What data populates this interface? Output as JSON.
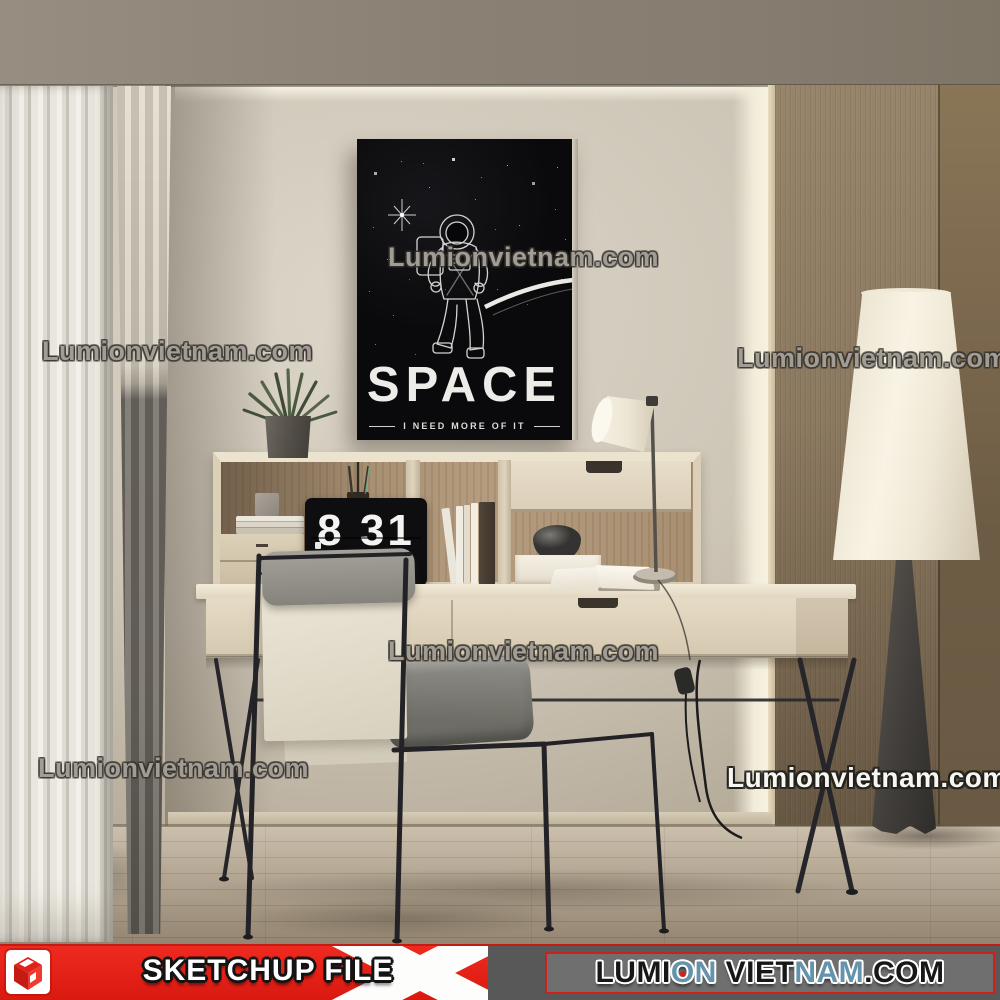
{
  "scene": {
    "poster": {
      "title": "SPACE",
      "tagline": "I NEED MORE OF IT"
    },
    "clock": {
      "time": "8 31"
    },
    "watermark": {
      "text": "Lumionvietnam.com"
    }
  },
  "banner": {
    "sketchup_label": "SKETCHUP FILE",
    "site_segments": [
      {
        "text": "LUMI",
        "color": "#17171a"
      },
      {
        "text": "O",
        "color": "#6493ab",
        "dot": true
      },
      {
        "text": "N",
        "color": "#6493ab"
      },
      {
        "text": " VIET",
        "color": "#17171a"
      },
      {
        "text": "NAM",
        "color": "#6493ab"
      },
      {
        "text": ".COM",
        "color": "#17171a"
      }
    ],
    "colors": {
      "red": "#e8251c",
      "blue": "#6493ab",
      "panel_gray": "#6f6f6f",
      "bar_gray": "#585858"
    }
  },
  "icons": {
    "logo": "sketchup-cube-logo"
  }
}
